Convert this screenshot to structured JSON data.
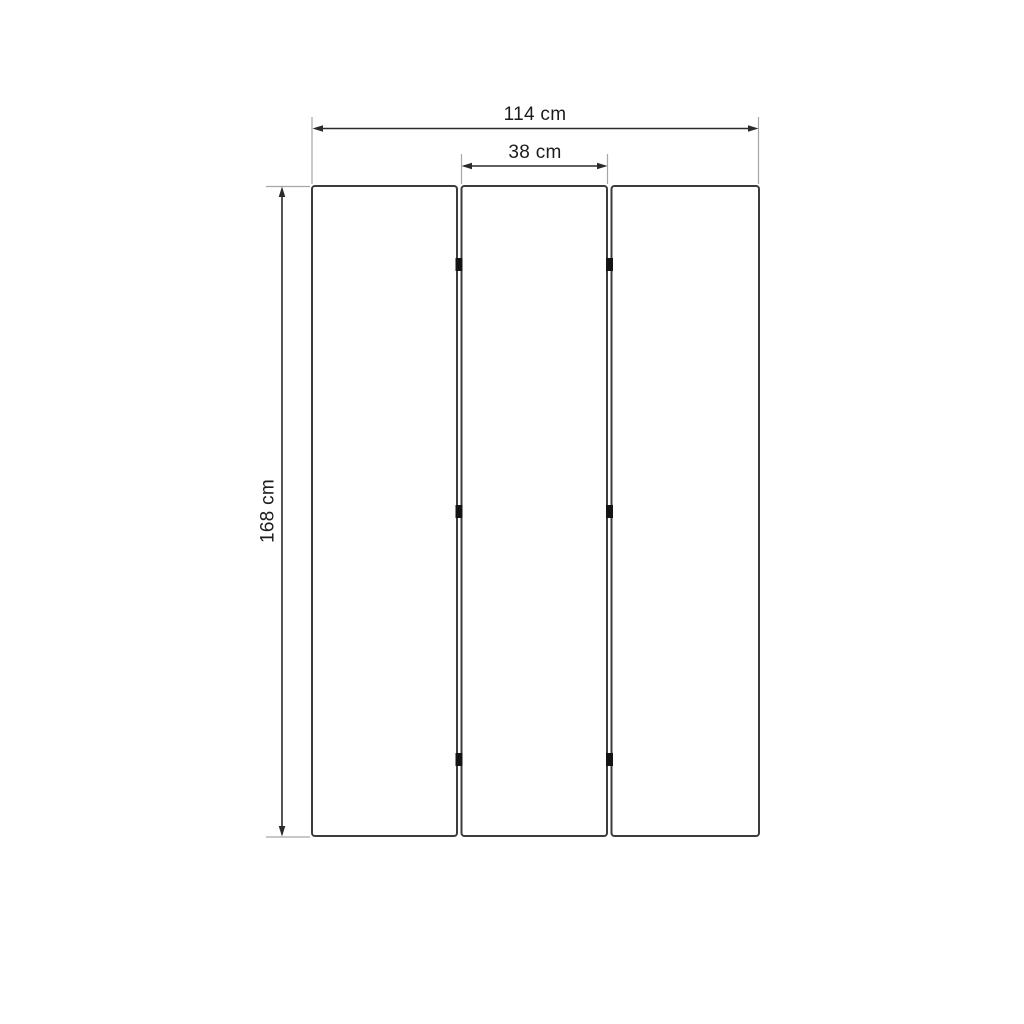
{
  "diagram": {
    "type": "dimension-drawing",
    "unit": "cm",
    "panel_count": 3,
    "hinge_rows": 3,
    "dimensions": {
      "total_width": {
        "label": "114 cm",
        "value": 114
      },
      "panel_width": {
        "label": "38 cm",
        "value": 38
      },
      "height": {
        "label": "168 cm",
        "value": 168
      }
    },
    "colors": {
      "background": "#ffffff",
      "panel_stroke": "#3c3c3c",
      "dimension_line": "#2b2b2b",
      "extension_line": "#a6a6a6",
      "text": "#1c1c1c",
      "hinge": "#141414"
    }
  }
}
